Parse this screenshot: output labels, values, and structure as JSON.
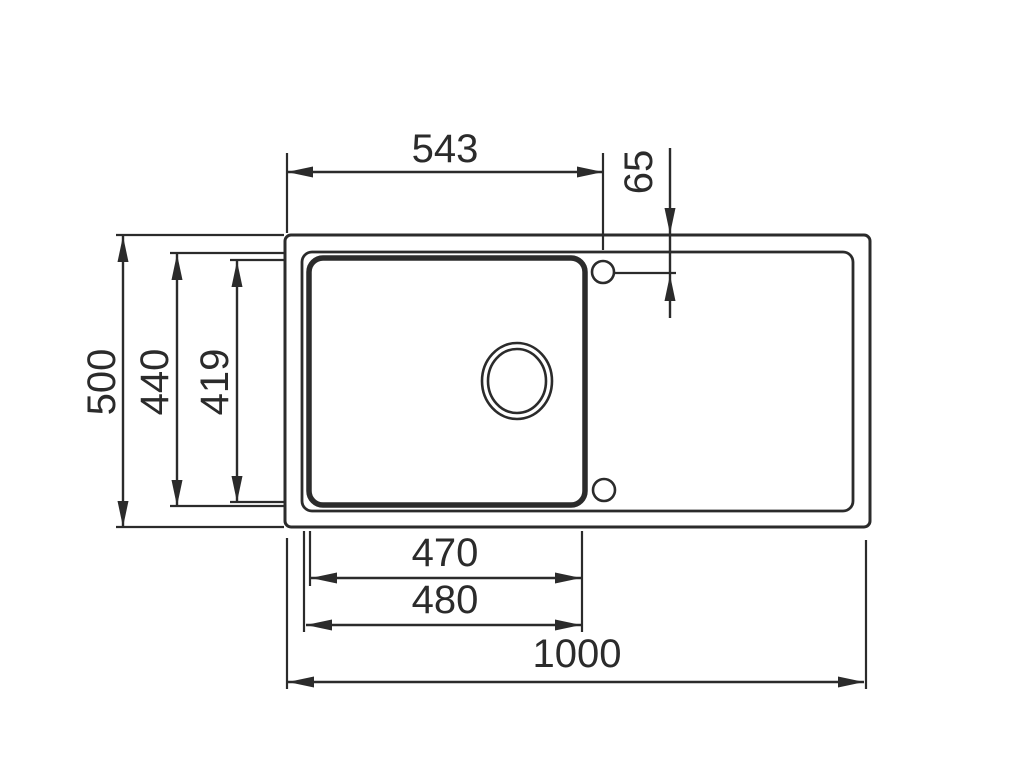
{
  "canvas": {
    "width": 1024,
    "height": 768,
    "background": "#ffffff",
    "line_color": "#2b2b2b",
    "font_size": 40,
    "arrow_length": 26,
    "arrow_half_width": 5.5
  },
  "sink": {
    "shapes": [
      {
        "name": "sink-outer-edge",
        "type": "rect",
        "x": 285,
        "y": 235,
        "w": 585,
        "h": 292,
        "rx": 6,
        "sw": 3
      },
      {
        "name": "sink-inner-rim",
        "type": "rect",
        "x": 302,
        "y": 252,
        "w": 551,
        "h": 259,
        "rx": 10,
        "sw": 2.8
      },
      {
        "name": "basin-outline",
        "type": "rect",
        "x": 309,
        "y": 258,
        "w": 276,
        "h": 247,
        "rx": 14,
        "sw": 5.5
      },
      {
        "name": "drain-outer-ring",
        "type": "ellipse",
        "cx": 517,
        "cy": 381,
        "rx": 35,
        "ry": 38,
        "sw": 2.6
      },
      {
        "name": "drain-inner-ring",
        "type": "ellipse",
        "cx": 517,
        "cy": 381,
        "rx": 29,
        "ry": 32,
        "sw": 2.6
      },
      {
        "name": "tap-hole-top",
        "type": "circle",
        "cx": 603,
        "cy": 272,
        "r": 11,
        "sw": 2.6
      },
      {
        "name": "tap-hole-bottom",
        "type": "circle",
        "cx": 604,
        "cy": 490,
        "r": 11,
        "sw": 2.6
      }
    ]
  },
  "dimensions": [
    {
      "name": "dim-543",
      "label": "543",
      "line": [
        287,
        172,
        603,
        172
      ],
      "arrows": [
        [
          287,
          172,
          "left"
        ],
        [
          603,
          172,
          "right"
        ]
      ],
      "ext": [
        [
          287,
          153,
          287,
          233
        ],
        [
          603,
          153,
          603,
          250
        ]
      ],
      "text": {
        "x": 445,
        "y": 162,
        "rotate": 0
      }
    },
    {
      "name": "dim-65",
      "label": "65",
      "line": [
        670,
        148,
        670,
        318
      ],
      "arrows": [
        [
          670,
          234,
          "down"
        ],
        [
          670,
          275,
          "up"
        ]
      ],
      "ext": [
        [
          614,
          273,
          676,
          273
        ]
      ],
      "text": {
        "x": 652,
        "y": 172,
        "rotate": -90
      }
    },
    {
      "name": "dim-500",
      "label": "500",
      "line": [
        123,
        235,
        123,
        527
      ],
      "arrows": [
        [
          123,
          236,
          "up"
        ],
        [
          123,
          527,
          "down"
        ]
      ],
      "ext": [
        [
          116,
          235,
          284,
          235
        ],
        [
          116,
          527,
          284,
          527
        ]
      ],
      "text": {
        "x": 115,
        "y": 382,
        "rotate": -90
      }
    },
    {
      "name": "dim-440",
      "label": "440",
      "line": [
        177,
        253,
        177,
        506
      ],
      "arrows": [
        [
          177,
          254,
          "up"
        ],
        [
          177,
          506,
          "down"
        ]
      ],
      "ext": [
        [
          170,
          253,
          284,
          253
        ],
        [
          170,
          506,
          284,
          506
        ]
      ],
      "text": {
        "x": 168,
        "y": 382,
        "rotate": -90
      }
    },
    {
      "name": "dim-419",
      "label": "419",
      "line": [
        237,
        260,
        237,
        502
      ],
      "arrows": [
        [
          237,
          261,
          "up"
        ],
        [
          237,
          502,
          "down"
        ]
      ],
      "ext": [
        [
          230,
          260,
          284,
          260
        ],
        [
          230,
          502,
          284,
          502
        ]
      ],
      "text": {
        "x": 228,
        "y": 382,
        "rotate": -90
      }
    },
    {
      "name": "dim-470",
      "label": "470",
      "line": [
        311,
        578,
        581,
        578
      ],
      "arrows": [
        [
          311,
          578,
          "left"
        ],
        [
          581,
          578,
          "right"
        ]
      ],
      "ext": [
        [
          310,
          531,
          310,
          586
        ],
        [
          582,
          531,
          582,
          632
        ]
      ],
      "text": {
        "x": 445,
        "y": 566,
        "rotate": 0
      }
    },
    {
      "name": "dim-480",
      "label": "480",
      "line": [
        306,
        625,
        581,
        625
      ],
      "arrows": [
        [
          306,
          625,
          "left"
        ],
        [
          581,
          625,
          "right"
        ]
      ],
      "ext": [
        [
          304,
          531,
          304,
          632
        ]
      ],
      "text": {
        "x": 445,
        "y": 613,
        "rotate": 0
      }
    },
    {
      "name": "dim-1000",
      "label": "1000",
      "line": [
        288,
        682,
        864,
        682
      ],
      "arrows": [
        [
          288,
          682,
          "left"
        ],
        [
          864,
          682,
          "right"
        ]
      ],
      "ext": [
        [
          287,
          538,
          287,
          689
        ],
        [
          866,
          540,
          866,
          689
        ]
      ],
      "text": {
        "x": 577,
        "y": 667,
        "rotate": 0
      }
    }
  ]
}
